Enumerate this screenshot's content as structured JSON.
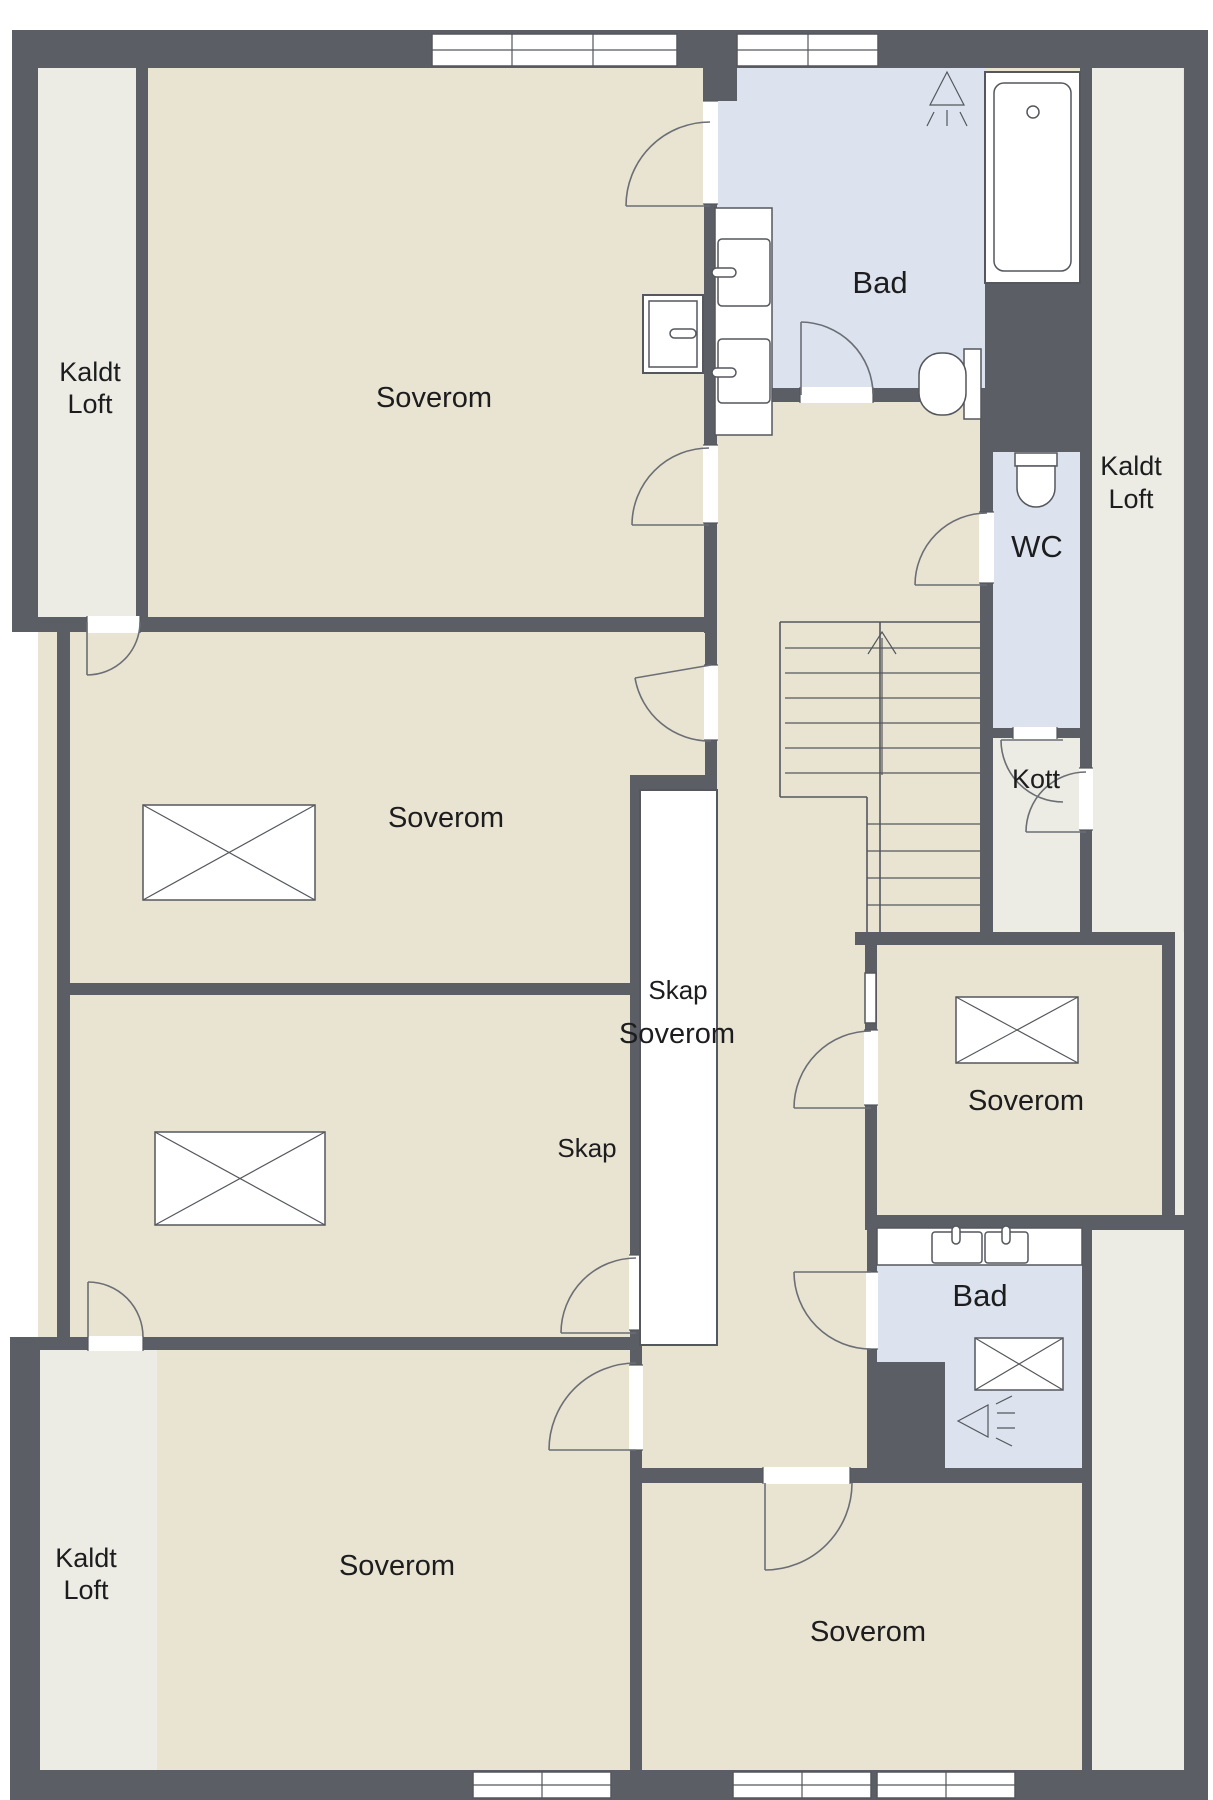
{
  "plan": {
    "type": "floor-plan",
    "floor_hint": "attic storey with cold loft zones",
    "language": "Norwegian",
    "colors": {
      "wall": "#5b5e64",
      "room_floor": "#e9e4d2",
      "cold_loft_floor": "#ecece4",
      "bathroom_floor": "#dce3ee",
      "fixture_line": "#54575d",
      "text": "#1d1d1f",
      "background": "#ffffff"
    },
    "rooms": [
      {
        "name": "kaldt-loft-top-left",
        "label": "Kaldt Loft"
      },
      {
        "name": "soverom-top-left",
        "label": "Soverom"
      },
      {
        "name": "bad-top",
        "label": "Bad"
      },
      {
        "name": "kaldt-loft-right",
        "label": "Kaldt Loft"
      },
      {
        "name": "wc",
        "label": "WC"
      },
      {
        "name": "kott",
        "label": "Kott"
      },
      {
        "name": "soverom-middle-left",
        "label": "Soverom"
      },
      {
        "name": "skap-closet",
        "label": "Skap"
      },
      {
        "name": "soverom-center",
        "label": "Soverom"
      },
      {
        "name": "soverom-middle-right",
        "label": "Soverom"
      },
      {
        "name": "skap-2",
        "label": "Skap"
      },
      {
        "name": "bad-bottom",
        "label": "Bad"
      },
      {
        "name": "kaldt-loft-bottom-left",
        "label": "Kaldt Loft"
      },
      {
        "name": "soverom-bottom-left",
        "label": "Soverom"
      },
      {
        "name": "soverom-bottom-right",
        "label": "Soverom"
      }
    ],
    "labels": [
      {
        "text": "Kaldt"
      },
      {
        "text": "Loft"
      },
      {
        "text": "Soverom"
      },
      {
        "text": "Bad"
      },
      {
        "text": "Kaldt"
      },
      {
        "text": "Loft"
      },
      {
        "text": "WC"
      },
      {
        "text": "Kott"
      },
      {
        "text": "Soverom"
      },
      {
        "text": "Skap"
      },
      {
        "text": "Soverom"
      },
      {
        "text": "Soverom"
      },
      {
        "text": "Skap"
      },
      {
        "text": "Bad"
      },
      {
        "text": "Kaldt"
      },
      {
        "text": "Loft"
      },
      {
        "text": "Soverom"
      },
      {
        "text": "Soverom"
      }
    ],
    "fixtures": [
      "bathtub",
      "shower-head-symbol",
      "double-sink-vanity-top",
      "toilet-bad",
      "toilet-wc",
      "shower-cabinet",
      "staircase-up",
      "roof-window-x4",
      "double-sink-vanity-bottom",
      "shower-tray",
      "wall-lamp-symbol",
      "windows-top-x2",
      "windows-bottom-x3"
    ]
  }
}
